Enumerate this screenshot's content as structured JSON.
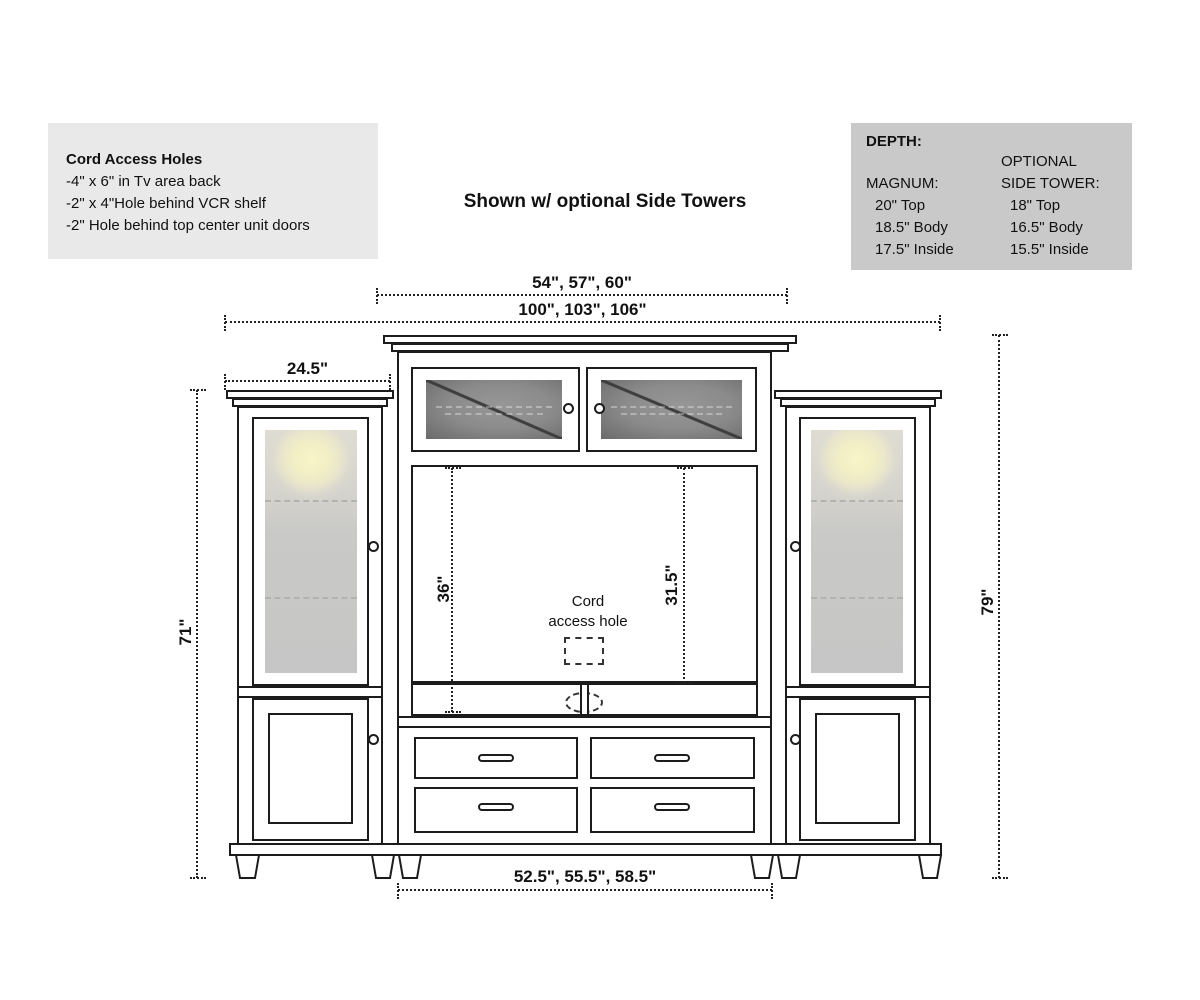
{
  "caption": "Shown w/ optional Side Towers",
  "notes_box": {
    "bg": "#e9e9e9",
    "title": "Cord Access Holes",
    "lines": [
      "-4\" x 6\" in Tv area back",
      "-2\" x 4\"Hole behind VCR shelf",
      "-2\" Hole behind top center unit doors"
    ]
  },
  "depth_box": {
    "bg": "#c9c9c9",
    "title": "DEPTH:",
    "magnum": {
      "header": "MAGNUM:",
      "rows": [
        "20\" Top",
        "18.5\" Body",
        "17.5\" Inside"
      ]
    },
    "side_tower": {
      "header_line1": "OPTIONAL",
      "header_line2": "SIDE TOWER:",
      "rows": [
        "18\" Top",
        "16.5\" Body",
        "15.5\" Inside"
      ]
    }
  },
  "dimensions": {
    "top_section_width": "54\", 57\", 60\"",
    "overall_width": "100\", 103\", 106\"",
    "side_tower_width": "24.5\"",
    "side_tower_height": "71\"",
    "overall_height": "79\"",
    "tv_area_height_left": "36\"",
    "tv_area_height_right": "31.5\"",
    "center_unit_width": "52.5\", 55.5\", 58.5\""
  },
  "drawing_labels": {
    "cord_hole_line1": "Cord",
    "cord_hole_line2": "access hole"
  }
}
